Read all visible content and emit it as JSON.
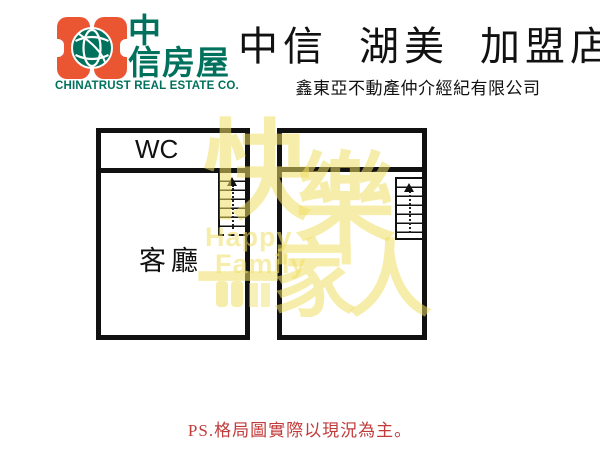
{
  "header": {
    "logo": {
      "brand_line1": "中",
      "brand_line2": "信房屋",
      "brand_en": "CHINATRUST REAL ESTATE CO."
    },
    "title": "中信 湖美 加盟店",
    "subtitle": "鑫東亞不動產仲介經紀有限公司"
  },
  "plans": {
    "left": {
      "wc_label": "WC",
      "living_label": "客廳",
      "stair_direction": "up"
    },
    "right": {
      "stair_direction": "up"
    }
  },
  "watermark": {
    "char1": "快",
    "char2": "樂",
    "line2": "一家人",
    "en1": "Happy",
    "en2": "Family"
  },
  "footer": {
    "note": "PS.格局圖實際以現況為主。"
  },
  "colors": {
    "brand_orange": "#EA5532",
    "brand_green": "#00715C",
    "note_red": "#C23B3B",
    "watermark_yellow": "rgba(240,222,100,0.55)",
    "line_black": "#111111"
  }
}
